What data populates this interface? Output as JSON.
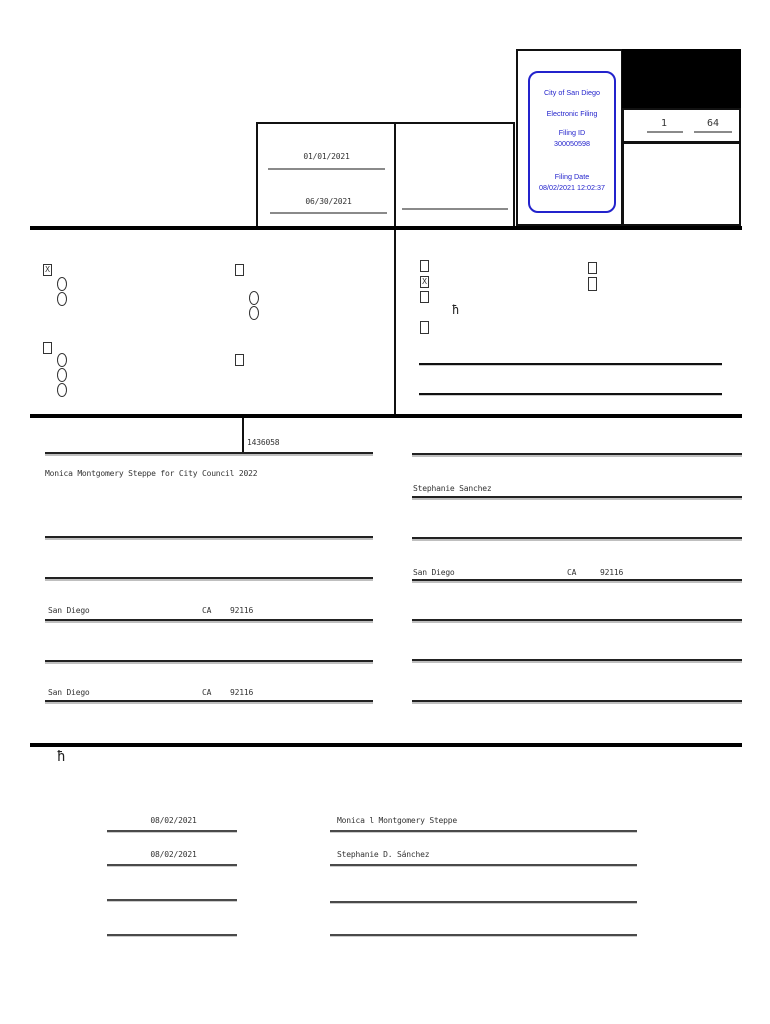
{
  "filing_stamp": {
    "org": "City of San Diego",
    "kind": "Electronic Filing",
    "filing_id_label": "Filing ID",
    "filing_id": "300050598",
    "filing_date_label": "Filing Date",
    "filing_datetime": "08/02/2021 12:02:37"
  },
  "page_counter": {
    "page": "1",
    "total": "64"
  },
  "period": {
    "from": "01/01/2021",
    "through": "06/30/2021"
  },
  "marks": {
    "left_statement_type": "X",
    "right_statement_type": "X"
  },
  "footnote_marker": "ħ",
  "id_number": "1436058",
  "left_column": {
    "committee_name": "Monica Montgomery Steppe for City Council 2022",
    "city1": "San Diego",
    "state1": "CA",
    "zip1": "92116",
    "city2": "San Diego",
    "state2": "CA",
    "zip2": "92116"
  },
  "right_column": {
    "treasurer_name": "Stephanie Sanchez",
    "city": "San Diego",
    "state": "CA",
    "zip": "92116"
  },
  "signatures": {
    "row1": {
      "date": "08/02/2021",
      "name": "Monica l Montgomery Steppe"
    },
    "row2": {
      "date": "08/02/2021",
      "name": "Stephanie D. Sánchez"
    }
  },
  "colors": {
    "stamp_blue": "#2323cc",
    "line_black": "#000000"
  }
}
